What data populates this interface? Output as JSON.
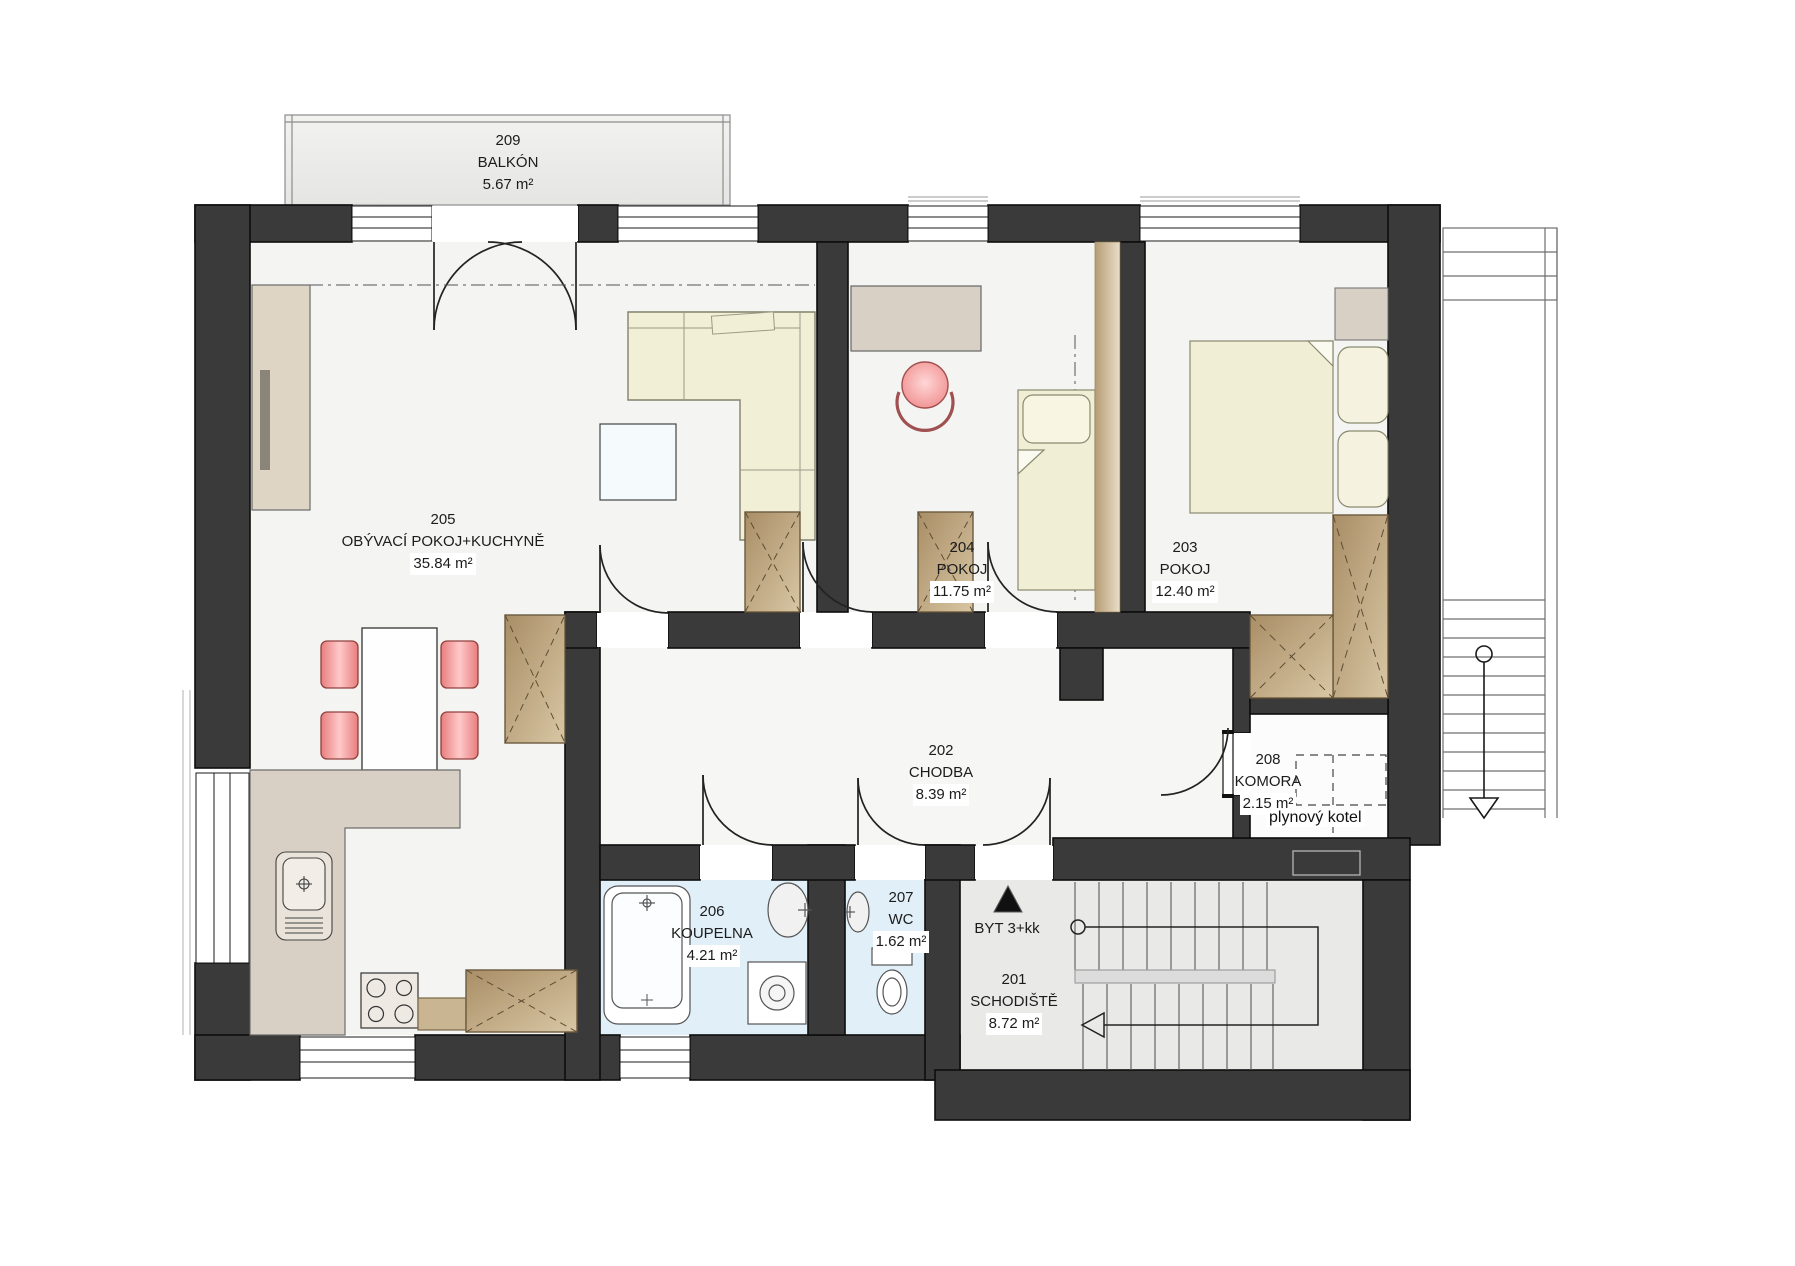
{
  "plan": {
    "title": "Apartment floor plan – 2nd floor (BYT 3+kk)",
    "rooms": [
      {
        "number": "209",
        "name": "BALKÓN",
        "area": "5.67 m²"
      },
      {
        "number": "205",
        "name": "OBÝVACÍ POKOJ+KUCHYNĚ",
        "area": "35.84 m²"
      },
      {
        "number": "204",
        "name": "POKOJ",
        "area": "11.75 m²"
      },
      {
        "number": "203",
        "name": "POKOJ",
        "area": "12.40 m²"
      },
      {
        "number": "202",
        "name": "CHODBA",
        "area": "8.39 m²"
      },
      {
        "number": "208",
        "name": "KOMORA",
        "area": "2.15 m²"
      },
      {
        "number": "206",
        "name": "KOUPELNA",
        "area": "4.21 m²"
      },
      {
        "number": "207",
        "name": "WC",
        "area": "1.62 m²"
      },
      {
        "number": "201",
        "name": "SCHODIŠTĚ",
        "area": "8.72 m²"
      }
    ],
    "annotations": {
      "entrance_label": "BYT 3+kk",
      "boiler_label": "plynový kotel"
    },
    "colors": {
      "wall": "#3a3a3a",
      "floor": "#f4f4f2",
      "wet_floor": "#e1eff8",
      "stair_floor": "#e9e9e8",
      "wood": "#b79d77",
      "counter": "#d8d0c4",
      "chair_accent": "#f08a8a",
      "bed": "#f1eed6"
    }
  }
}
